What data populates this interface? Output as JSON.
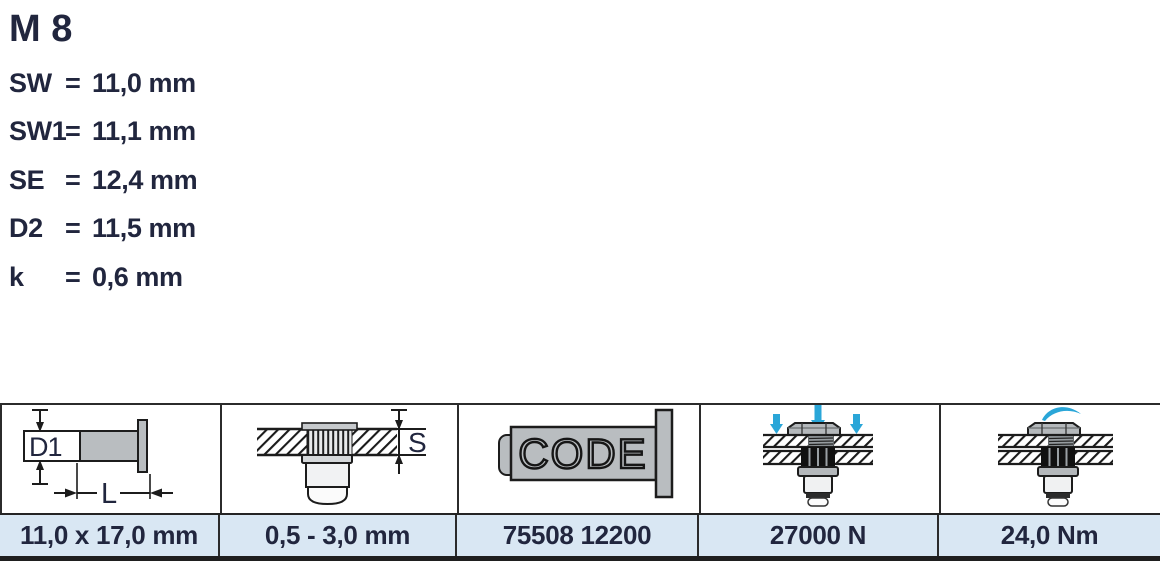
{
  "colors": {
    "text": "#21263e",
    "accent_blue": "#2aa6d8",
    "value_row_bg": "#d9e7f3",
    "table_border": "#2b2b2b",
    "drawing_gray": "#b9bdc0"
  },
  "specs": {
    "title": "M 8",
    "equals_sign": "=",
    "rows": [
      {
        "label": "SW",
        "value": "11,0 mm"
      },
      {
        "label": "SW1",
        "value": "11,1 mm"
      },
      {
        "label": "SE",
        "value": "12,4 mm"
      },
      {
        "label": "D2",
        "value": "11,5 mm"
      },
      {
        "label": "k",
        "value": "0,6 mm"
      }
    ]
  },
  "table": {
    "drawing_labels": {
      "diameter": "D1",
      "length": "L",
      "grip": "S",
      "code": "CODE"
    },
    "cells": [
      {
        "name": "dimensions",
        "value": "11,0 x 17,0 mm"
      },
      {
        "name": "grip-range",
        "value": "0,5 - 3,0 mm"
      },
      {
        "name": "article-code",
        "value": "75508 12200"
      },
      {
        "name": "tensile-strength",
        "value": "27000 N"
      },
      {
        "name": "max-torque",
        "value": "24,0 Nm"
      }
    ]
  }
}
